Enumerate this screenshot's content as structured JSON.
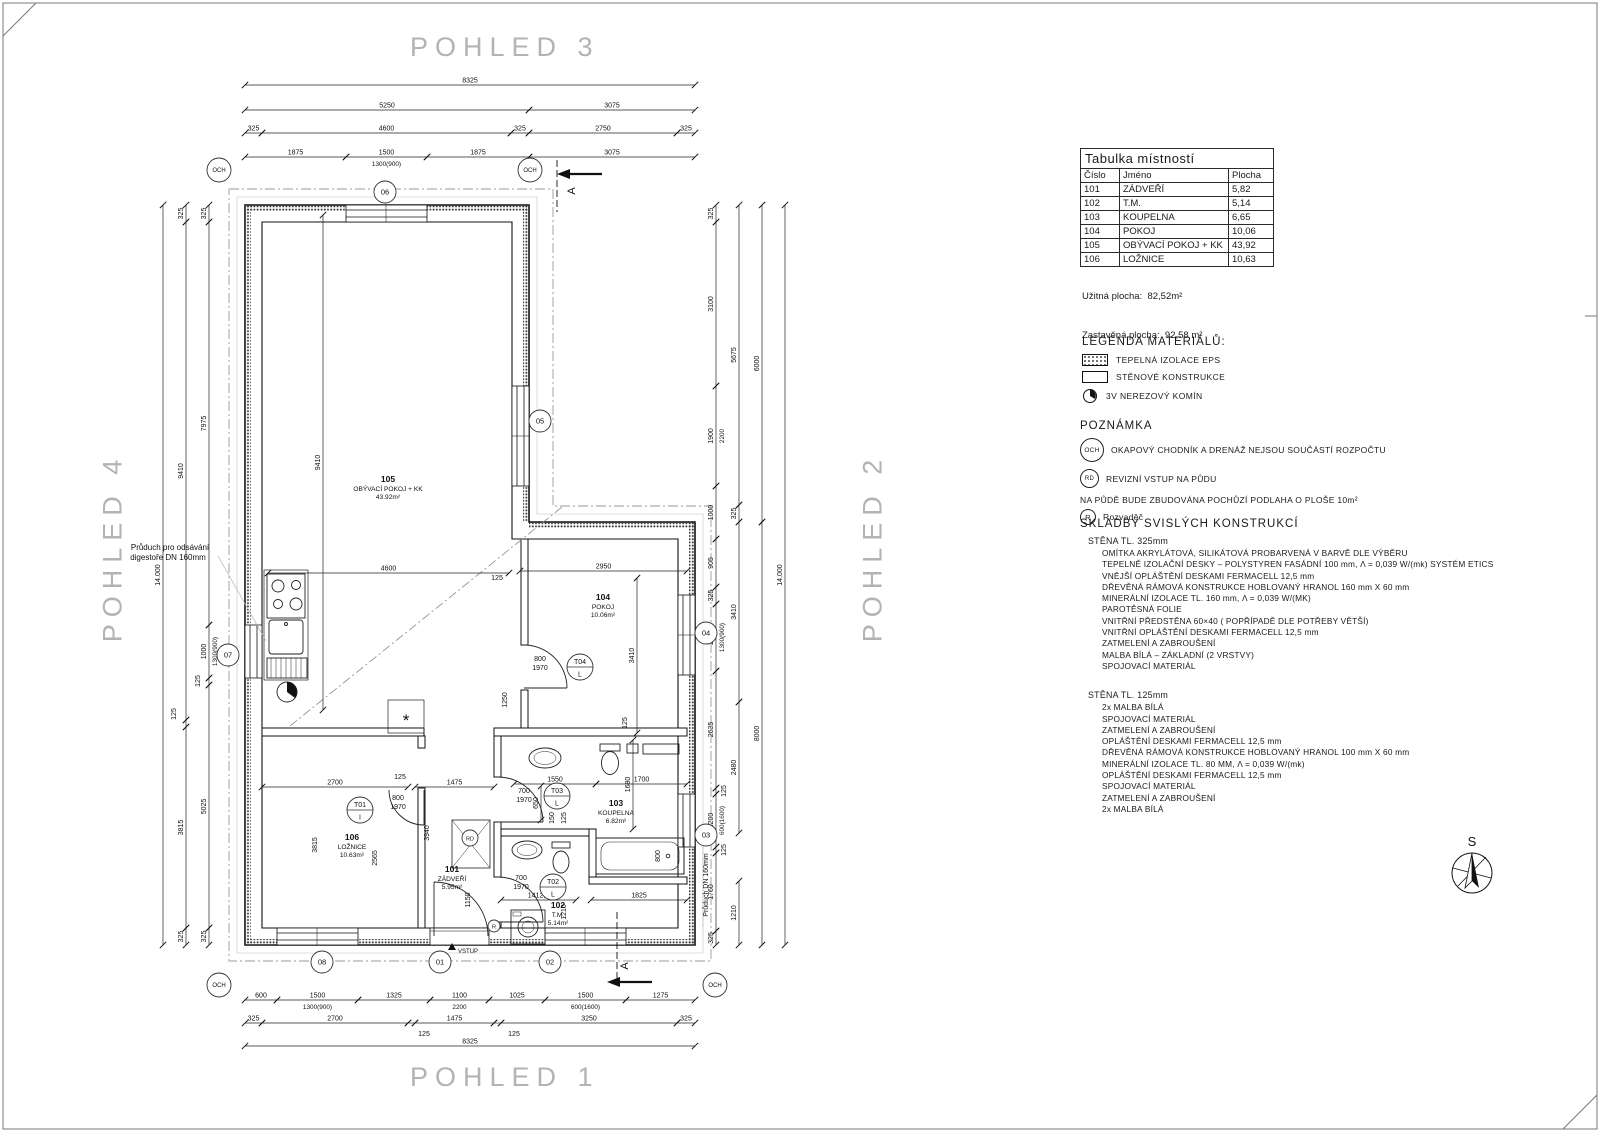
{
  "titles": {
    "top": "POHLED 3",
    "bottom": "POHLED 1",
    "left": "POHLED 4",
    "right": "POHLED 2"
  },
  "room_table": {
    "title": "Tabulka místností",
    "headers": [
      "Číslo",
      "Jméno",
      "Plocha"
    ],
    "rows": [
      [
        "101",
        "ZÁDVEŘÍ",
        "5,82"
      ],
      [
        "102",
        "T.M.",
        "5,14"
      ],
      [
        "103",
        "KOUPELNA",
        "6,65"
      ],
      [
        "104",
        "POKOJ",
        "10,06"
      ],
      [
        "105",
        "OBÝVACÍ POKOJ + KK",
        "43,92"
      ],
      [
        "106",
        "LOŽNICE",
        "10,63"
      ]
    ],
    "useful_area": "Užitná plocha:  82,52m²",
    "built_area": "Zastavěná plocha:  92,58 m²"
  },
  "legend": {
    "title": "LEGENDA MATERIÁLŮ:",
    "items": [
      {
        "swatch": "hatch",
        "label": "TEPELNÁ IZOLACE EPS"
      },
      {
        "swatch": "plain",
        "label": "STĚNOVÉ KONSTRUKCE"
      },
      {
        "swatch": "chimney",
        "label": "3V NEREZOVÝ KOMÍN"
      }
    ]
  },
  "notes": {
    "title": "POZNÁMKA",
    "rows": [
      {
        "badge": "OCH",
        "badge_class": "och",
        "text": "OKAPOVÝ CHODNÍK A DRENÁŽ NEJSOU SOUČÁSTÍ ROZPOČTU"
      },
      {
        "badge": "RD",
        "badge_class": "rd",
        "text": "REVIZNÍ VSTUP NA PŮDU"
      }
    ],
    "attic_text": "NA PŮDĚ BUDE ZBUDOVÁNA POCHŮZÍ PODLAHA O PLOŠE 10m²",
    "r_row": {
      "badge": "R",
      "badge_class": "r",
      "text": "Rozvaděč"
    }
  },
  "compositions": {
    "title": "SKLADBY SVISLÝCH KONSTRUKCÍ",
    "walls": [
      {
        "header": "STĚNA TL. 325mm",
        "layers": [
          "OMÍTKA AKRYLÁTOVÁ, SILIKÁTOVÁ PROBARVENÁ V BARVĚ DLE VÝBĚRU",
          "TEPELNĚ IZOLAČNÍ DESKY – POLYSTYREN FASÁDNÍ 100 mm, Λ = 0,039 W/(mk) SYSTÉM ETICS",
          "VNĚJŠÍ OPLÁŠTĚNÍ DESKAMI FERMACELL 12,5 mm",
          "DŘEVĚNÁ RÁMOVÁ KONSTRUKCE HOBLOVANÝ HRANOL 160 mm X 60 mm",
          "MINERÁLNÍ IZOLACE TL. 160 mm, Λ = 0,039 W/(MK)",
          "PAROTĚSNÁ FOLIE",
          "VNITŘNÍ PŘEDSTĚNA 60×40 ( POPŘÍPADĚ DLE POTŘEBY VĚTŠÍ)",
          "VNITŘNÍ OPLÁŠTĚNÍ DESKAMI FERMACELL 12,5 mm",
          "ZATMELENÍ A ZABROUŠENÍ",
          "MALBA BÍLÁ – ZÁKLADNÍ (2 VRSTVY)",
          "SPOJOVACÍ MATERIÁL"
        ]
      },
      {
        "header": "STĚNA TL. 125mm",
        "layers": [
          "2x MALBA BÍLÁ",
          "SPOJOVACÍ MATERIÁL",
          "ZATMELENÍ A ZABROUŠENÍ",
          "OPLÁŠTĚNÍ DESKAMI FERMACELL 12,5 mm",
          "DŘEVĚNÁ RÁMOVÁ KONSTRUKCE HOBLOVANÝ HRANOL 100 mm X 60 mm",
          "MINERÁLNÍ IZOLACE TL. 80 MM, Λ = 0,039 W/(mk)",
          "OPLÁŠTĚNÍ DESKAMI FERMACELL 12,5 mm",
          "SPOJOVACÍ MATERIÁL",
          "ZATMELENÍ A ZABROUŠENÍ",
          "2x MALBA BÍLÁ"
        ]
      }
    ]
  },
  "plan": {
    "rooms": [
      {
        "num": "105",
        "name": "OBÝVACÍ POKOJ + KK",
        "area": "43.92m²",
        "x": 388,
        "y": 482
      },
      {
        "num": "104",
        "name": "POKOJ",
        "area": "10.06m²",
        "x": 603,
        "y": 600
      },
      {
        "num": "103",
        "name": "KOUPELNA",
        "area": "6.82m²",
        "x": 616,
        "y": 806
      },
      {
        "num": "102",
        "name": "T.M.",
        "area": "5.14m²",
        "x": 558,
        "y": 908
      },
      {
        "num": "101",
        "name": "ZÁDVEŘÍ",
        "area": "5.95m²",
        "x": 452,
        "y": 872
      },
      {
        "num": "106",
        "name": "LOŽNICE",
        "area": "10.63m²",
        "x": 352,
        "y": 840
      }
    ],
    "doors": [
      {
        "id": "T01",
        "letter": "I",
        "x": 360,
        "y": 810
      },
      {
        "id": "T02",
        "letter": "L",
        "x": 553,
        "y": 887
      },
      {
        "id": "T03",
        "letter": "L",
        "x": 557,
        "y": 796
      },
      {
        "id": "T04",
        "letter": "L",
        "x": 580,
        "y": 667
      }
    ],
    "markers": [
      {
        "t": "06",
        "x": 385,
        "y": 192
      },
      {
        "t": "05",
        "x": 540,
        "y": 421
      },
      {
        "t": "04",
        "x": 706,
        "y": 633
      },
      {
        "t": "03",
        "x": 706,
        "y": 835
      },
      {
        "t": "07",
        "x": 228,
        "y": 655
      },
      {
        "t": "08",
        "x": 322,
        "y": 962
      },
      {
        "t": "01",
        "x": 440,
        "y": 962
      },
      {
        "t": "02",
        "x": 550,
        "y": 962
      },
      {
        "t": "OCH",
        "x": 219,
        "y": 170
      },
      {
        "t": "OCH",
        "x": 530,
        "y": 170
      },
      {
        "t": "OCH",
        "x": 219,
        "y": 985
      },
      {
        "t": "OCH",
        "x": 715,
        "y": 985
      },
      {
        "t": "RD",
        "x": 470,
        "y": 838
      },
      {
        "t": "R",
        "x": 494,
        "y": 926
      }
    ],
    "dims": [
      {
        "t": "8325",
        "x1": 245,
        "y1": 85,
        "x2": 695,
        "y2": 85
      },
      {
        "t": "5250",
        "x1": 245,
        "y1": 110,
        "x2": 529,
        "y2": 110
      },
      {
        "t": "3075",
        "x1": 529,
        "y1": 110,
        "x2": 695,
        "y2": 110
      },
      {
        "t": "325",
        "x1": 245,
        "y1": 133,
        "x2": 262,
        "y2": 133
      },
      {
        "t": "4600",
        "x1": 262,
        "y1": 133,
        "x2": 511,
        "y2": 133
      },
      {
        "t": "325",
        "x1": 511,
        "y1": 133,
        "x2": 529,
        "y2": 133
      },
      {
        "t": "2750",
        "x1": 529,
        "y1": 133,
        "x2": 677,
        "y2": 133
      },
      {
        "t": "325",
        "x1": 677,
        "y1": 133,
        "x2": 695,
        "y2": 133
      },
      {
        "t": "1875",
        "x1": 245,
        "y1": 157,
        "x2": 346,
        "y2": 157
      },
      {
        "t": "1500",
        "x1": 346,
        "y1": 157,
        "x2": 427,
        "y2": 157,
        "sub": "1300(900)"
      },
      {
        "t": "1875",
        "x1": 427,
        "y1": 157,
        "x2": 529,
        "y2": 157
      },
      {
        "t": "3075",
        "x1": 529,
        "y1": 157,
        "x2": 695,
        "y2": 157
      },
      {
        "t": "600",
        "x1": 245,
        "y1": 1000,
        "x2": 277,
        "y2": 1000
      },
      {
        "t": "1500",
        "x1": 277,
        "y1": 1000,
        "x2": 358,
        "y2": 1000,
        "sub": "1300(900)"
      },
      {
        "t": "1325",
        "x1": 358,
        "y1": 1000,
        "x2": 430,
        "y2": 1000
      },
      {
        "t": "1100",
        "x1": 430,
        "y1": 1000,
        "x2": 489,
        "y2": 1000,
        "sub": "2200"
      },
      {
        "t": "1025",
        "x1": 489,
        "y1": 1000,
        "x2": 545,
        "y2": 1000
      },
      {
        "t": "1500",
        "x1": 545,
        "y1": 1000,
        "x2": 626,
        "y2": 1000,
        "sub": "600(1600)"
      },
      {
        "t": "1275",
        "x1": 626,
        "y1": 1000,
        "x2": 695,
        "y2": 1000
      },
      {
        "t": "325",
        "x1": 245,
        "y1": 1023,
        "x2": 262,
        "y2": 1023
      },
      {
        "t": "2700",
        "x1": 262,
        "y1": 1023,
        "x2": 408,
        "y2": 1023
      },
      {
        "t": "",
        "x1": 408,
        "y1": 1023,
        "x2": 415,
        "y2": 1023
      },
      {
        "t": "1475",
        "x1": 415,
        "y1": 1023,
        "x2": 494,
        "y2": 1023
      },
      {
        "t": "",
        "x1": 494,
        "y1": 1023,
        "x2": 501,
        "y2": 1023
      },
      {
        "t": "3250",
        "x1": 501,
        "y1": 1023,
        "x2": 677,
        "y2": 1023
      },
      {
        "t": "325",
        "x1": 677,
        "y1": 1023,
        "x2": 695,
        "y2": 1023
      },
      {
        "t": "8325",
        "x1": 245,
        "y1": 1046,
        "x2": 695,
        "y2": 1046
      },
      {
        "t": "14.000",
        "x1": 163,
        "y1": 205,
        "x2": 163,
        "y2": 945
      },
      {
        "t": "325",
        "x1": 186,
        "y1": 205,
        "x2": 186,
        "y2": 222
      },
      {
        "t": "9410",
        "x1": 186,
        "y1": 222,
        "x2": 186,
        "y2": 720
      },
      {
        "t": "",
        "x1": 186,
        "y1": 720,
        "x2": 186,
        "y2": 727
      },
      {
        "t": "3815",
        "x1": 186,
        "y1": 727,
        "x2": 186,
        "y2": 928
      },
      {
        "t": "325",
        "x1": 186,
        "y1": 928,
        "x2": 186,
        "y2": 945
      },
      {
        "t": "325",
        "x1": 209,
        "y1": 205,
        "x2": 209,
        "y2": 222
      },
      {
        "t": "7975",
        "x1": 209,
        "y1": 222,
        "x2": 209,
        "y2": 625
      },
      {
        "t": "1000",
        "x1": 209,
        "y1": 625,
        "x2": 209,
        "y2": 678,
        "sub": "1300(900)"
      },
      {
        "t": "",
        "x1": 209,
        "y1": 678,
        "x2": 209,
        "y2": 685
      },
      {
        "t": "5025",
        "x1": 209,
        "y1": 685,
        "x2": 209,
        "y2": 928
      },
      {
        "t": "325",
        "x1": 209,
        "y1": 928,
        "x2": 209,
        "y2": 945
      },
      {
        "t": "14.000",
        "x1": 785,
        "y1": 205,
        "x2": 785,
        "y2": 945
      },
      {
        "t": "6000",
        "x1": 762,
        "y1": 205,
        "x2": 762,
        "y2": 522
      },
      {
        "t": "8000",
        "x1": 762,
        "y1": 522,
        "x2": 762,
        "y2": 945
      },
      {
        "t": "5675",
        "x1": 739,
        "y1": 205,
        "x2": 739,
        "y2": 505
      },
      {
        "t": "325",
        "x1": 739,
        "y1": 505,
        "x2": 739,
        "y2": 522
      },
      {
        "t": "3410",
        "x1": 739,
        "y1": 522,
        "x2": 739,
        "y2": 702
      },
      {
        "t": "2480",
        "x1": 739,
        "y1": 702,
        "x2": 739,
        "y2": 833
      },
      {
        "t": "1210",
        "x1": 739,
        "y1": 881,
        "x2": 739,
        "y2": 945
      },
      {
        "t": "325",
        "x1": 716,
        "y1": 205,
        "x2": 716,
        "y2": 222
      },
      {
        "t": "3100",
        "x1": 716,
        "y1": 222,
        "x2": 716,
        "y2": 386
      },
      {
        "t": "1900",
        "x1": 716,
        "y1": 386,
        "x2": 716,
        "y2": 486,
        "sub": "2200"
      },
      {
        "t": "1000",
        "x1": 716,
        "y1": 486,
        "x2": 716,
        "y2": 539
      },
      {
        "t": "905",
        "x1": 716,
        "y1": 539,
        "x2": 716,
        "y2": 587
      },
      {
        "t": "325",
        "x1": 716,
        "y1": 587,
        "x2": 716,
        "y2": 604
      },
      {
        "t": "1500",
        "x1": 716,
        "y1": 604,
        "x2": 716,
        "y2": 671,
        "sub": "1300(900)"
      },
      {
        "t": "2635",
        "x1": 716,
        "y1": 671,
        "x2": 716,
        "y2": 788
      },
      {
        "t": "",
        "x1": 716,
        "y1": 788,
        "x2": 716,
        "y2": 794
      },
      {
        "t": "1200",
        "x1": 716,
        "y1": 794,
        "x2": 716,
        "y2": 847,
        "sub": "600(1600)"
      },
      {
        "t": "",
        "x1": 716,
        "y1": 847,
        "x2": 716,
        "y2": 853
      },
      {
        "t": "1760",
        "x1": 716,
        "y1": 853,
        "x2": 716,
        "y2": 931
      },
      {
        "t": "325",
        "x1": 716,
        "y1": 931,
        "x2": 716,
        "y2": 945
      },
      {
        "t": "4600",
        "x1": 268,
        "y1": 573,
        "x2": 509,
        "y2": 573
      },
      {
        "t": "9410",
        "x1": 323,
        "y1": 215,
        "x2": 323,
        "y2": 710
      },
      {
        "t": "2950",
        "x1": 520,
        "y1": 571,
        "x2": 687,
        "y2": 571
      },
      {
        "t": "3410",
        "x1": 637,
        "y1": 578,
        "x2": 637,
        "y2": 733
      },
      {
        "t": "2700",
        "x1": 262,
        "y1": 787,
        "x2": 408,
        "y2": 787
      },
      {
        "t": "1475",
        "x1": 415,
        "y1": 787,
        "x2": 494,
        "y2": 787
      },
      {
        "t": "1550",
        "x1": 514,
        "y1": 784,
        "x2": 596,
        "y2": 784
      },
      {
        "t": "1700",
        "x1": 596,
        "y1": 784,
        "x2": 687,
        "y2": 784
      },
      {
        "t": "1680",
        "x1": 633,
        "y1": 740,
        "x2": 633,
        "y2": 829
      },
      {
        "t": "650",
        "x1": 541,
        "y1": 786,
        "x2": 541,
        "y2": 820
      },
      {
        "t": "1825",
        "x1": 591,
        "y1": 900,
        "x2": 687,
        "y2": 900
      },
      {
        "t": "1412,5",
        "x1": 501,
        "y1": 900,
        "x2": 576,
        "y2": 900
      }
    ],
    "leaders": [
      {
        "t": "125",
        "x": 497,
        "y": 580
      },
      {
        "t": "125",
        "x": 400,
        "y": 779
      },
      {
        "t": "125",
        "x": 424,
        "y": 1036
      },
      {
        "t": "125",
        "x": 514,
        "y": 1036
      },
      {
        "t": "125",
        "x": 176,
        "y": 714,
        "rot": -90
      },
      {
        "t": "125",
        "x": 200,
        "y": 681,
        "rot": -90
      },
      {
        "t": "125",
        "x": 726,
        "y": 791,
        "rot": -90
      },
      {
        "t": "125",
        "x": 726,
        "y": 850,
        "rot": -90
      },
      {
        "t": "125",
        "x": 627,
        "y": 723,
        "rot": -90
      },
      {
        "t": "125",
        "x": 566,
        "y": 818,
        "rot": -90
      },
      {
        "t": "150",
        "x": 554,
        "y": 818,
        "rot": -90
      },
      {
        "t": "1250",
        "x": 507,
        "y": 700,
        "rot": -90
      },
      {
        "t": "800",
        "x": 660,
        "y": 856,
        "rot": -90
      },
      {
        "t": "1210",
        "x": 566,
        "y": 912,
        "rot": -90
      },
      {
        "t": "3815",
        "x": 317,
        "y": 845,
        "rot": -90
      },
      {
        "t": "2565",
        "x": 377,
        "y": 858,
        "rot": -90
      },
      {
        "t": "3940",
        "x": 429,
        "y": 833,
        "rot": -90
      },
      {
        "t": "1150",
        "x": 470,
        "y": 900,
        "rot": -90
      },
      {
        "t": "800",
        "x": 398,
        "y": 800
      },
      {
        "t": "1970",
        "x": 398,
        "y": 809
      },
      {
        "t": "800",
        "x": 540,
        "y": 661
      },
      {
        "t": "1970",
        "x": 540,
        "y": 670
      },
      {
        "t": "700",
        "x": 524,
        "y": 793
      },
      {
        "t": "1970",
        "x": 524,
        "y": 802
      },
      {
        "t": "700",
        "x": 521,
        "y": 880
      },
      {
        "t": "1970",
        "x": 521,
        "y": 889
      }
    ],
    "texts": [
      {
        "t": "VSTUP",
        "x": 468,
        "y": 953,
        "size": 6,
        "color": "#8a8a8a"
      },
      {
        "t": "Průduch pro odsávání",
        "x": 170,
        "y": 550,
        "size": 8,
        "color": "#9a9a9a"
      },
      {
        "t": "digestoře DN 160mm",
        "x": 168,
        "y": 560,
        "size": 8,
        "color": "#9a9a9a"
      },
      {
        "t": "Průduch DN 160mm",
        "x": 708,
        "y": 885,
        "rot": -90,
        "size": 7,
        "color": "#9a9a9a"
      },
      {
        "t": "A",
        "x": 575,
        "y": 191,
        "rot": -90,
        "size": 11,
        "color": "#111"
      },
      {
        "t": "A",
        "x": 628,
        "y": 966,
        "rot": -90,
        "size": 11,
        "color": "#111"
      },
      {
        "t": "S",
        "x": 1472,
        "y": 846,
        "size": 13,
        "color": "#333"
      },
      {
        "t": "*",
        "x": 406,
        "y": 726,
        "size": 17,
        "color": "#222"
      }
    ]
  }
}
